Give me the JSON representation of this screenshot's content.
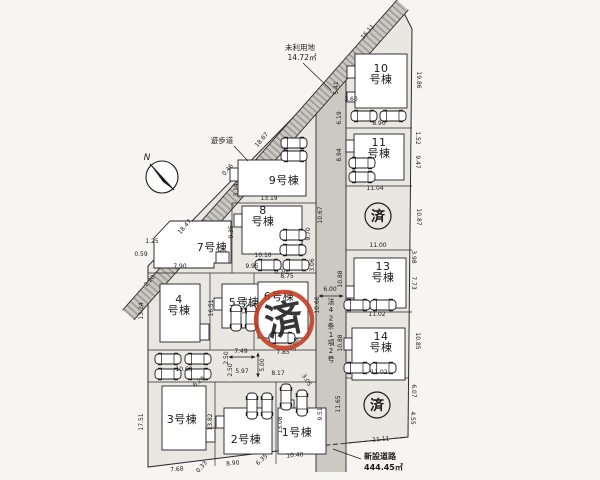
{
  "annotations": {
    "north": "N",
    "walkway": "遊歩道",
    "unused_land": [
      "未利用地",
      "14.72㎡"
    ],
    "road_law": "法42条1項2号",
    "new_road": [
      "新設道路",
      "444.45㎡"
    ],
    "sold_mark": "済"
  },
  "colors": {
    "stamp_red": "#c53a20",
    "ink": "#1b1b1b",
    "site_fill": "#e9e7e2",
    "road_fill": "#ccc9c3"
  },
  "lots": [
    {
      "name": "1号棟",
      "lines": [
        "1号棟"
      ],
      "x": 297,
      "y": 436
    },
    {
      "name": "2号棟",
      "lines": [
        "2号棟"
      ],
      "x": 246,
      "y": 443
    },
    {
      "name": "3号棟",
      "lines": [
        "3号棟"
      ],
      "x": 182,
      "y": 423
    },
    {
      "name": "4号棟",
      "lines": [
        "4",
        "号棟"
      ],
      "x": 179,
      "y": 303
    },
    {
      "name": "5号棟",
      "lines": [
        "5号棟"
      ],
      "x": 244,
      "y": 306
    },
    {
      "name": "6号棟",
      "lines": [
        "6号棟"
      ],
      "x": 279,
      "y": 300
    },
    {
      "name": "7号棟",
      "lines": [
        "7号棟"
      ],
      "x": 212,
      "y": 251
    },
    {
      "name": "8号棟",
      "lines": [
        "8",
        "号棟"
      ],
      "x": 263,
      "y": 214
    },
    {
      "name": "9号棟",
      "lines": [
        "9号棟"
      ],
      "x": 284,
      "y": 184
    },
    {
      "name": "10号棟",
      "lines": [
        "10",
        "号棟"
      ],
      "x": 381,
      "y": 72
    },
    {
      "name": "11号棟",
      "lines": [
        "11",
        "号棟"
      ],
      "x": 379,
      "y": 146
    },
    {
      "name": "13号棟",
      "lines": [
        "13",
        "号棟"
      ],
      "x": 383,
      "y": 270
    },
    {
      "name": "14号棟",
      "lines": [
        "14",
        "号棟"
      ],
      "x": 381,
      "y": 340
    }
  ],
  "stamps": [
    {
      "text": "済",
      "style": "red",
      "x": 284,
      "y": 320
    },
    {
      "text": "済",
      "style": "ink",
      "x": 378,
      "y": 216
    },
    {
      "text": "済",
      "style": "ink",
      "x": 377,
      "y": 405
    }
  ],
  "dimensions": [
    {
      "v": "16.11",
      "x": 369,
      "y": 33,
      "r": -49
    },
    {
      "v": "18.67",
      "x": 263,
      "y": 141,
      "r": -49
    },
    {
      "v": "18.47",
      "x": 186,
      "y": 228,
      "r": -49
    },
    {
      "v": "0.46",
      "x": 229,
      "y": 171,
      "r": -49
    },
    {
      "v": "2.20",
      "x": 151,
      "y": 282,
      "r": -49
    },
    {
      "v": "1.25",
      "x": 152,
      "y": 243,
      "r": 0
    },
    {
      "v": "0.59",
      "x": 141,
      "y": 256,
      "r": 0
    },
    {
      "v": "5.41",
      "x": 338,
      "y": 88,
      "r": -90
    },
    {
      "v": "3.60",
      "x": 351,
      "y": 101,
      "r": 0
    },
    {
      "v": "6.19",
      "x": 341,
      "y": 118,
      "r": -90
    },
    {
      "v": "3.14",
      "x": 238,
      "y": 190,
      "r": -90
    },
    {
      "v": "8.90",
      "x": 379,
      "y": 125,
      "r": 0
    },
    {
      "v": "1.52",
      "x": 416,
      "y": 138,
      "r": 90
    },
    {
      "v": "9.47",
      "x": 416,
      "y": 162,
      "r": 90
    },
    {
      "v": "8.94",
      "x": 341,
      "y": 155,
      "r": -90
    },
    {
      "v": "11.04",
      "x": 375,
      "y": 190,
      "r": 0
    },
    {
      "v": "19.86",
      "x": 417,
      "y": 80,
      "r": 90
    },
    {
      "v": "10.87",
      "x": 417,
      "y": 217,
      "r": 90
    },
    {
      "v": "10.67",
      "x": 322,
      "y": 215,
      "r": -90
    },
    {
      "v": "13.19",
      "x": 269,
      "y": 200,
      "r": 0
    },
    {
      "v": "9.35",
      "x": 233,
      "y": 232,
      "r": -90
    },
    {
      "v": "9.70",
      "x": 310,
      "y": 234,
      "r": -90
    },
    {
      "v": "10.10",
      "x": 263,
      "y": 257,
      "r": 0
    },
    {
      "v": "0.70",
      "x": 281,
      "y": 274,
      "r": 0
    },
    {
      "v": "3.06",
      "x": 314,
      "y": 265,
      "r": -90
    },
    {
      "v": "7.90",
      "x": 180,
      "y": 268,
      "r": 0
    },
    {
      "v": "9.95",
      "x": 252,
      "y": 268,
      "r": 0
    },
    {
      "v": "8.75",
      "x": 287,
      "y": 278,
      "r": 0
    },
    {
      "v": "13.24",
      "x": 143,
      "y": 311,
      "r": -90
    },
    {
      "v": "16.51",
      "x": 213,
      "y": 308,
      "r": -90
    },
    {
      "v": "13.01",
      "x": 247,
      "y": 306,
      "r": -90
    },
    {
      "v": "10.66",
      "x": 319,
      "y": 305,
      "r": -90
    },
    {
      "v": "11.00",
      "x": 378,
      "y": 247,
      "r": 0
    },
    {
      "v": "3.98",
      "x": 412,
      "y": 257,
      "r": 90
    },
    {
      "v": "7.73",
      "x": 412,
      "y": 283,
      "r": 90
    },
    {
      "v": "10.88",
      "x": 342,
      "y": 279,
      "r": -90
    },
    {
      "v": "10.88",
      "x": 342,
      "y": 343,
      "r": -90
    },
    {
      "v": "6.00",
      "x": 330,
      "y": 291,
      "r": 0
    },
    {
      "v": "11.02",
      "x": 377,
      "y": 316,
      "r": 0
    },
    {
      "v": "10.85",
      "x": 416,
      "y": 341,
      "r": 90
    },
    {
      "v": "11.02",
      "x": 379,
      "y": 374,
      "r": 0
    },
    {
      "v": "6.07",
      "x": 412,
      "y": 391,
      "r": 90
    },
    {
      "v": "4.55",
      "x": 411,
      "y": 418,
      "r": 90
    },
    {
      "v": "11.65",
      "x": 340,
      "y": 404,
      "r": -90
    },
    {
      "v": "11.11",
      "x": 381,
      "y": 441,
      "r": -4
    },
    {
      "v": "7.49",
      "x": 241,
      "y": 353,
      "r": 0
    },
    {
      "v": "7.85",
      "x": 283,
      "y": 354,
      "r": 0
    },
    {
      "v": "5.00",
      "x": 264,
      "y": 365,
      "r": -90
    },
    {
      "v": "2.50",
      "x": 228,
      "y": 358,
      "r": -90
    },
    {
      "v": "2.50",
      "x": 232,
      "y": 370,
      "r": -90
    },
    {
      "v": "5.97",
      "x": 242,
      "y": 373,
      "r": 0
    },
    {
      "v": "8.17",
      "x": 278,
      "y": 375,
      "r": 0
    },
    {
      "v": "10.60",
      "x": 184,
      "y": 371,
      "r": 0
    },
    {
      "v": "6.26",
      "x": 200,
      "y": 383,
      "r": -38
    },
    {
      "v": "3.05",
      "x": 305,
      "y": 381,
      "r": 58
    },
    {
      "v": "3.66",
      "x": 297,
      "y": 345,
      "r": -75
    },
    {
      "v": "17.51",
      "x": 143,
      "y": 422,
      "r": -90
    },
    {
      "v": "13.82",
      "x": 212,
      "y": 422,
      "r": -90
    },
    {
      "v": "13.08",
      "x": 282,
      "y": 425,
      "r": -90
    },
    {
      "v": "9.51",
      "x": 322,
      "y": 414,
      "r": -90
    },
    {
      "v": "10.40",
      "x": 295,
      "y": 457,
      "r": -5
    },
    {
      "v": "6.35",
      "x": 263,
      "y": 461,
      "r": -42
    },
    {
      "v": "8.90",
      "x": 233,
      "y": 465,
      "r": -6
    },
    {
      "v": "0.33",
      "x": 203,
      "y": 468,
      "r": -48
    },
    {
      "v": "7.68",
      "x": 177,
      "y": 471,
      "r": -4
    }
  ],
  "cars": [
    {
      "x": 364,
      "y": 116,
      "r": 0
    },
    {
      "x": 393,
      "y": 116,
      "r": 0
    },
    {
      "x": 362,
      "y": 163,
      "r": 0
    },
    {
      "x": 362,
      "y": 177,
      "r": 0
    },
    {
      "x": 294,
      "y": 143,
      "r": 0
    },
    {
      "x": 294,
      "y": 156,
      "r": 0
    },
    {
      "x": 293,
      "y": 235,
      "r": 0
    },
    {
      "x": 293,
      "y": 250,
      "r": 0
    },
    {
      "x": 268,
      "y": 265,
      "r": 0
    },
    {
      "x": 296,
      "y": 265,
      "r": 0
    },
    {
      "x": 168,
      "y": 359,
      "r": 0
    },
    {
      "x": 198,
      "y": 359,
      "r": 0
    },
    {
      "x": 168,
      "y": 374,
      "r": 0
    },
    {
      "x": 198,
      "y": 374,
      "r": 0
    },
    {
      "x": 236,
      "y": 318,
      "r": 90
    },
    {
      "x": 251,
      "y": 318,
      "r": 90
    },
    {
      "x": 282,
      "y": 338,
      "r": 0
    },
    {
      "x": 252,
      "y": 406,
      "r": 90
    },
    {
      "x": 267,
      "y": 406,
      "r": 90
    },
    {
      "x": 286,
      "y": 397,
      "r": 90
    },
    {
      "x": 302,
      "y": 403,
      "r": 90
    },
    {
      "x": 357,
      "y": 305,
      "r": 0
    },
    {
      "x": 383,
      "y": 305,
      "r": 0
    },
    {
      "x": 357,
      "y": 368,
      "r": 0
    },
    {
      "x": 383,
      "y": 368,
      "r": 0
    }
  ]
}
